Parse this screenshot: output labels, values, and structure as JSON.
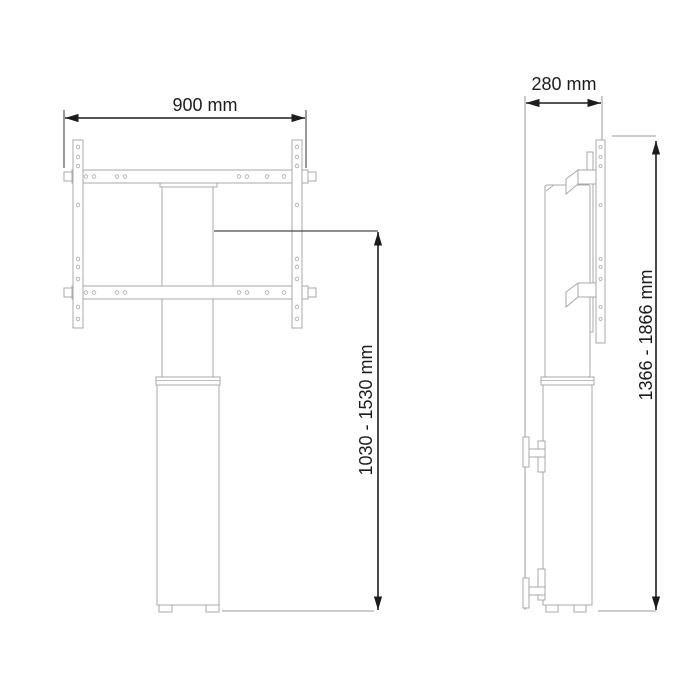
{
  "colors": {
    "background": "#ffffff",
    "product-line": "#a9a9a9",
    "dimension": "#1c1c1c",
    "leader": "#9a9a9a"
  },
  "front_view": {
    "width_label": "900 mm",
    "height_label": "1030 - 1530 mm"
  },
  "side_view": {
    "depth_label": "280 mm",
    "height_label": "1366 - 1866 mm"
  }
}
